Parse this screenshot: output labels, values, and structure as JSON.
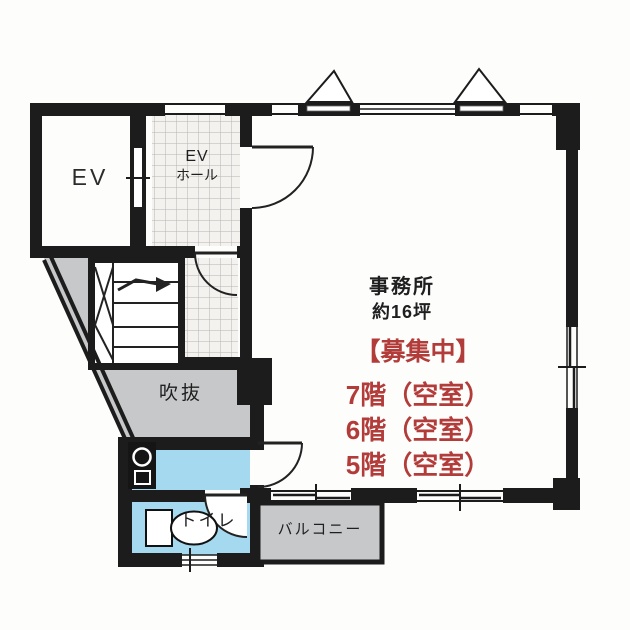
{
  "floor_plan": {
    "rooms": {
      "elevator": "EV",
      "elevator_hall": [
        "EV",
        "ホール"
      ],
      "office": {
        "name": "事務所",
        "area": "約16坪"
      },
      "void": "吹抜",
      "toilet": "トイレ",
      "balcony": "バルコニー"
    },
    "vacancy_notice": {
      "header": "【募集中】",
      "floors": [
        "7階（空室）",
        "6階（空室）",
        "5階（空室）"
      ]
    },
    "colors": {
      "wall": "#1c1c1c",
      "vacancy_text": "#b23c3a",
      "wet_area_fill": "#a5d9ef",
      "void_and_balcony_fill": "#c6c8ca",
      "tile_grid": "#b4b4b4"
    }
  }
}
